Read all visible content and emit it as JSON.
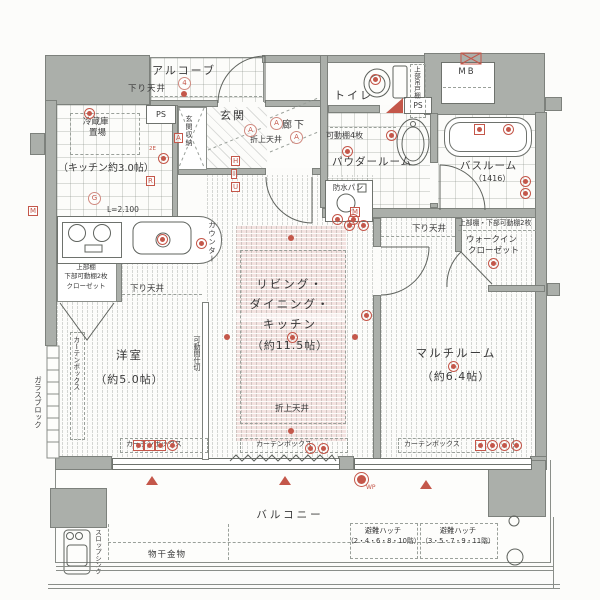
{
  "palette": {
    "wall": "#abafaa",
    "wall_line": "#7d817c",
    "fixture_line": "#5f635e",
    "accent_red": "#c4574a",
    "ldk_pink": "#f3e2e0",
    "text": "#3a3a3a"
  },
  "labels": {
    "alcove": "アルコーブ",
    "shita_tenjo": "下り天井",
    "oriage_tenjo": "折上天井",
    "ps": "PS",
    "mb": "MB",
    "genkan": "玄関",
    "genkan_shuno": "玄関収納",
    "reizoko1": "冷蔵庫",
    "reizoko2": "置場",
    "kitchen": "（キッチン約3.0帖）",
    "l2100": "L=2.100",
    "counter": "カウンター",
    "roka": "廊下",
    "toilet": "トイレ",
    "tsuridana": "上部吊戸棚",
    "powder": "パウダールーム",
    "kadodana4": "可動棚4枚",
    "bosui_pan": "防水パン",
    "bath": "バスルーム",
    "bath_size": "（1416）",
    "shelf2": "上部棚・下部可動棚2枚",
    "wic1": "ウォークイン",
    "wic2": "クローゼット",
    "multi": "マルチルーム",
    "multi_size": "（約6.4帖）",
    "ldk1": "リビング・",
    "ldk2": "ダイニング・",
    "ldk3": "キッチン",
    "ldk_size": "（約11.5帖）",
    "yoshitsu": "洋室",
    "yoshitsu_size": "（約5.0帖）",
    "closet1": "上部棚",
    "closet2": "下部可動棚2枚",
    "closet3": "クローゼット",
    "kado_majikiri": "可動間仕切",
    "glass_block": "ガラスブロック",
    "curtain_box": "カーテンボックス",
    "balcony": "バルコニー",
    "hatch": "避難ハッチ",
    "hatch1_floors": "（2・4・6・8・10階）",
    "hatch2_floors": "（3・5・7・9・11階）",
    "monohoshi": "物干金物",
    "slop_sink": "スロップシンク",
    "wp": "WP",
    "m_a": "A",
    "m_h": "H",
    "m_i": "I",
    "m_u": "U",
    "m_m": "M",
    "m_r": "R",
    "m_g": "G",
    "m_2e": "2E",
    "m_4": "4"
  }
}
